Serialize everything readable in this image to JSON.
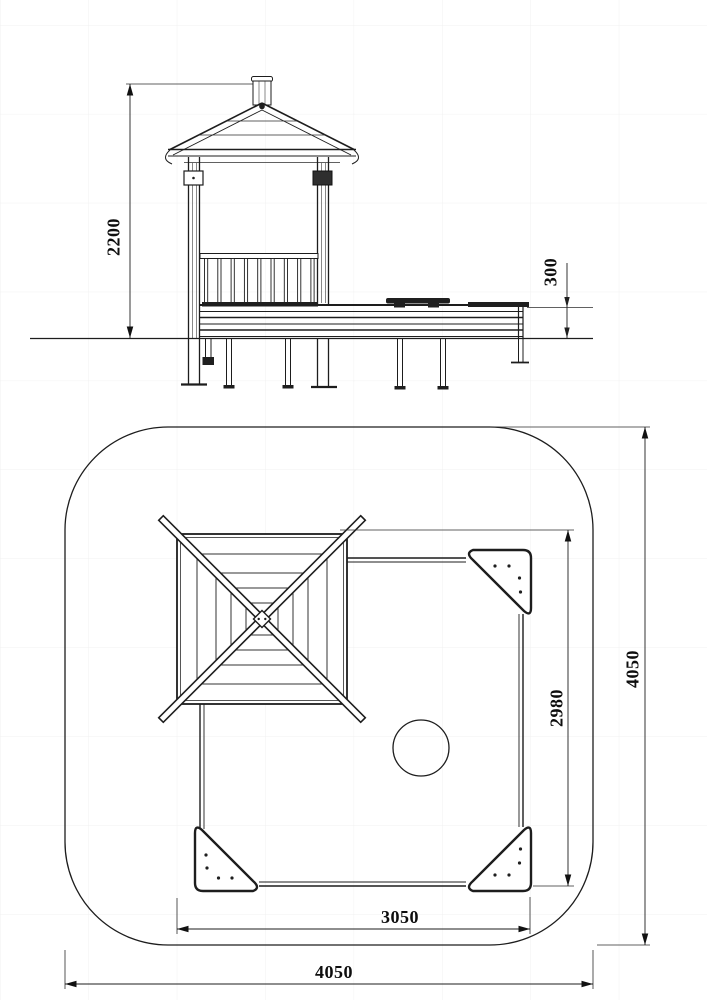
{
  "document": {
    "type": "technical-drawing",
    "subject": "sandbox-with-gazebo-playground-unit",
    "background_color": "#ffffff",
    "line_color": "#1d1d1d",
    "grid_color": "#f1f1f1"
  },
  "views": {
    "elevation": {
      "label": "side-elevation",
      "dim_overall_height": {
        "value": "2200"
      },
      "dim_frame_height": {
        "value": "300"
      }
    },
    "plan": {
      "label": "top-plan",
      "dim_sandbox_depth": {
        "value": "2980"
      },
      "dim_sandbox_width": {
        "value": "3050"
      },
      "dim_zone_depth": {
        "value": "4050"
      },
      "dim_zone_width": {
        "value": "4050"
      }
    }
  }
}
